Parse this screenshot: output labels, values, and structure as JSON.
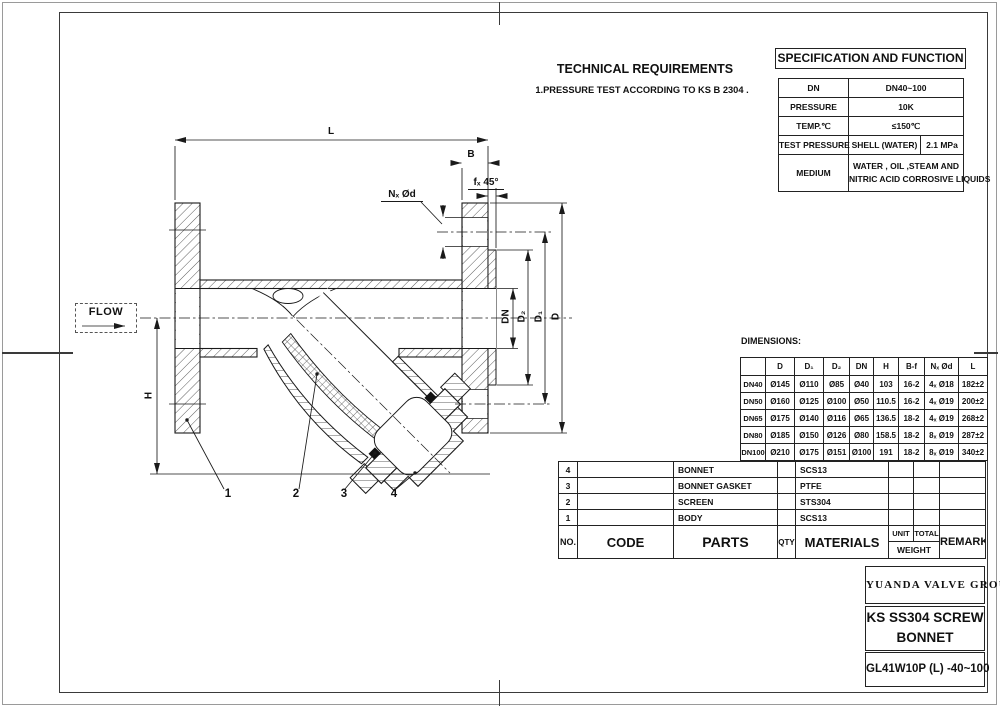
{
  "technical_requirements": {
    "title": "TECHNICAL REQUIREMENTS",
    "note": "1.PRESSURE TEST ACCORDING TO KS B 2304 ."
  },
  "specification": {
    "title": "SPECIFICATION AND FUNCTION",
    "dn_label": "DN",
    "dn_value": "DN40~100",
    "pressure_label": "PRESSURE",
    "pressure_value": "10K",
    "temp_label": "TEMP.℃",
    "temp_value": "≤150℃",
    "test_label": "TEST PRESSURE",
    "test_mid": "SHELL (WATER)",
    "test_value": "2.1 MPa",
    "medium_label": "MEDIUM",
    "medium_line1": "WATER , OIL ,STEAM AND",
    "medium_line2": "NITRIC ACID CORROSIVE LIQUIDS"
  },
  "dimensions_table": {
    "caption": "DIMENSIONS:",
    "headers": [
      "",
      "D",
      "D₁",
      "D₂",
      "DN",
      "H",
      "B-f",
      "Nₓ Ød",
      "L"
    ],
    "rows": [
      [
        "DN40",
        "Ø145",
        "Ø110",
        "Ø85",
        "Ø40",
        "103",
        "16-2",
        "4ₓ Ø18",
        "182±2"
      ],
      [
        "DN50",
        "Ø160",
        "Ø125",
        "Ø100",
        "Ø50",
        "110.5",
        "16-2",
        "4ₓ Ø19",
        "200±2"
      ],
      [
        "DN65",
        "Ø175",
        "Ø140",
        "Ø116",
        "Ø65",
        "136.5",
        "18-2",
        "4ₓ Ø19",
        "268±2"
      ],
      [
        "DN80",
        "Ø185",
        "Ø150",
        "Ø126",
        "Ø80",
        "158.5",
        "18-2",
        "8ₓ Ø19",
        "287±2"
      ],
      [
        "DN100",
        "Ø210",
        "Ø175",
        "Ø151",
        "Ø100",
        "191",
        "18-2",
        "8ₓ Ø19",
        "340±2"
      ]
    ]
  },
  "parts_table": {
    "headers": {
      "no": "NO.",
      "code": "CODE",
      "parts": "PARTS",
      "qty": "QTY",
      "materials": "MATERIALS",
      "unit": "UNIT",
      "total": "TOTAL",
      "weight": "WEIGHT",
      "remark": "REMARK"
    },
    "rows": [
      {
        "no": "4",
        "code": "",
        "part": "BONNET",
        "qty": "",
        "material": "SCS13",
        "unit": "",
        "total": "",
        "remark": ""
      },
      {
        "no": "3",
        "code": "",
        "part": "BONNET GASKET",
        "qty": "",
        "material": "PTFE",
        "unit": "",
        "total": "",
        "remark": ""
      },
      {
        "no": "2",
        "code": "",
        "part": "SCREEN",
        "qty": "",
        "material": "STS304",
        "unit": "",
        "total": "",
        "remark": ""
      },
      {
        "no": "1",
        "code": "",
        "part": "BODY",
        "qty": "",
        "material": "SCS13",
        "unit": "",
        "total": "",
        "remark": ""
      }
    ]
  },
  "title_block": {
    "company": "YUANDA VALVE GROUP",
    "product_line1": "KS SS304 SCREW",
    "product_line2": "BONNET STRAINER",
    "model": "GL41W10P (L) -40~100"
  },
  "drawing": {
    "flow_label": "FLOW",
    "labels": {
      "L": "L",
      "B": "B",
      "f": "fₓ 45°",
      "n_od": "Nₓ Ød",
      "DN": "DN",
      "D2": "D₂",
      "D1": "D₁",
      "D": "D",
      "H": "H"
    },
    "part_numbers": [
      "1",
      "2",
      "3",
      "4"
    ]
  },
  "colors": {
    "line": "#1a1a1a",
    "hatch": "#4a4a4a",
    "frame": "#3a3a3a"
  }
}
